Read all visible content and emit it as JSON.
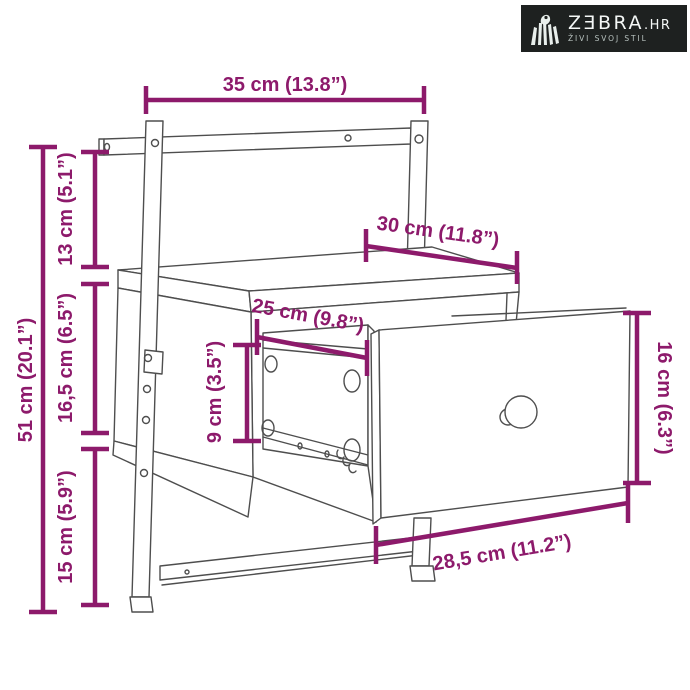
{
  "page": {
    "background": "#ffffff"
  },
  "logo": {
    "brand": "ZƎBRA",
    "tld": ".HR",
    "tagline": "ŽIVI SVOJ STIL",
    "bg_color": "#1e2120",
    "text_color": "#f4f7f6",
    "tagline_color": "#b9c3c0",
    "icon": "zebra-stripes-icon"
  },
  "diagram": {
    "subject": "wall-mounted bedside cabinet with pulled-out drawer, technical line drawing",
    "accent_color": "#8D1A6B",
    "line_color": "#4e4e4e",
    "dimensions": {
      "top_width": "35 cm (13.8”)",
      "total_height": "51 cm (20.1”)",
      "upper_gap": "13 cm (5.1”)",
      "body_height": "16,5 cm (6.5”)",
      "lower_gap": "15 cm (5.9”)",
      "top_depth": "30 cm (11.8”)",
      "inner_depth": "25 cm (9.8”)",
      "opening_height": "9 cm (3.5”)",
      "drawer_front_height": "16 cm (6.3”)",
      "drawer_front_width": "28,5 cm (11.2”)"
    }
  }
}
